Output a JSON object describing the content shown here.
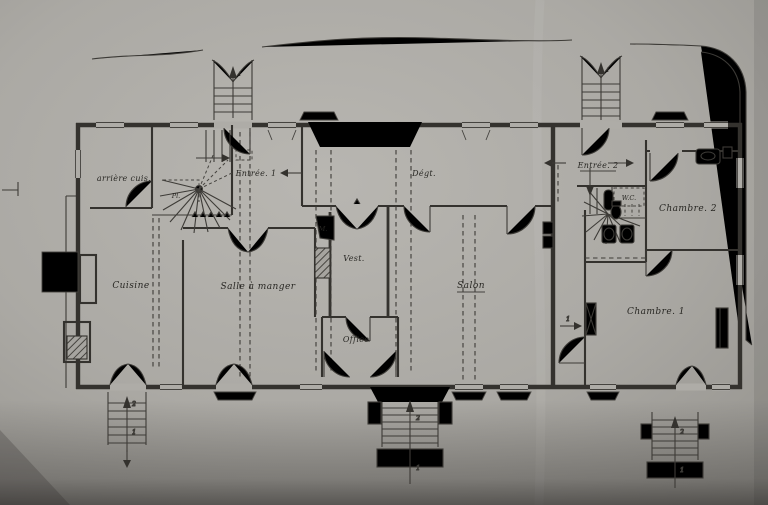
{
  "photo": {
    "description": "scanned hand-drawn architectural floor plan (ground floor of a house, French labels)",
    "paper_color": "#b2b0ab",
    "ink_color": "#34322e",
    "shadow_color": "#4b4945"
  },
  "plan": {
    "labels": {
      "arriere_cuisine": "arrière cuis.",
      "placard": "Pl.",
      "entree_1": "Entrée. 1",
      "degagement": "Dégt.",
      "monte": "M.",
      "vestibule": "Vest.",
      "cuisine": "Cuisine",
      "salle_a_manger": "Salle à manger",
      "office": "Office",
      "salon": "Salon",
      "entree_2": "Entrée. 2",
      "wc": "W.C.",
      "chambre_2": "Chambre. 2",
      "chambre_1": "Chambre. 1"
    },
    "step_marks": {
      "one": "1",
      "two": "2"
    }
  }
}
